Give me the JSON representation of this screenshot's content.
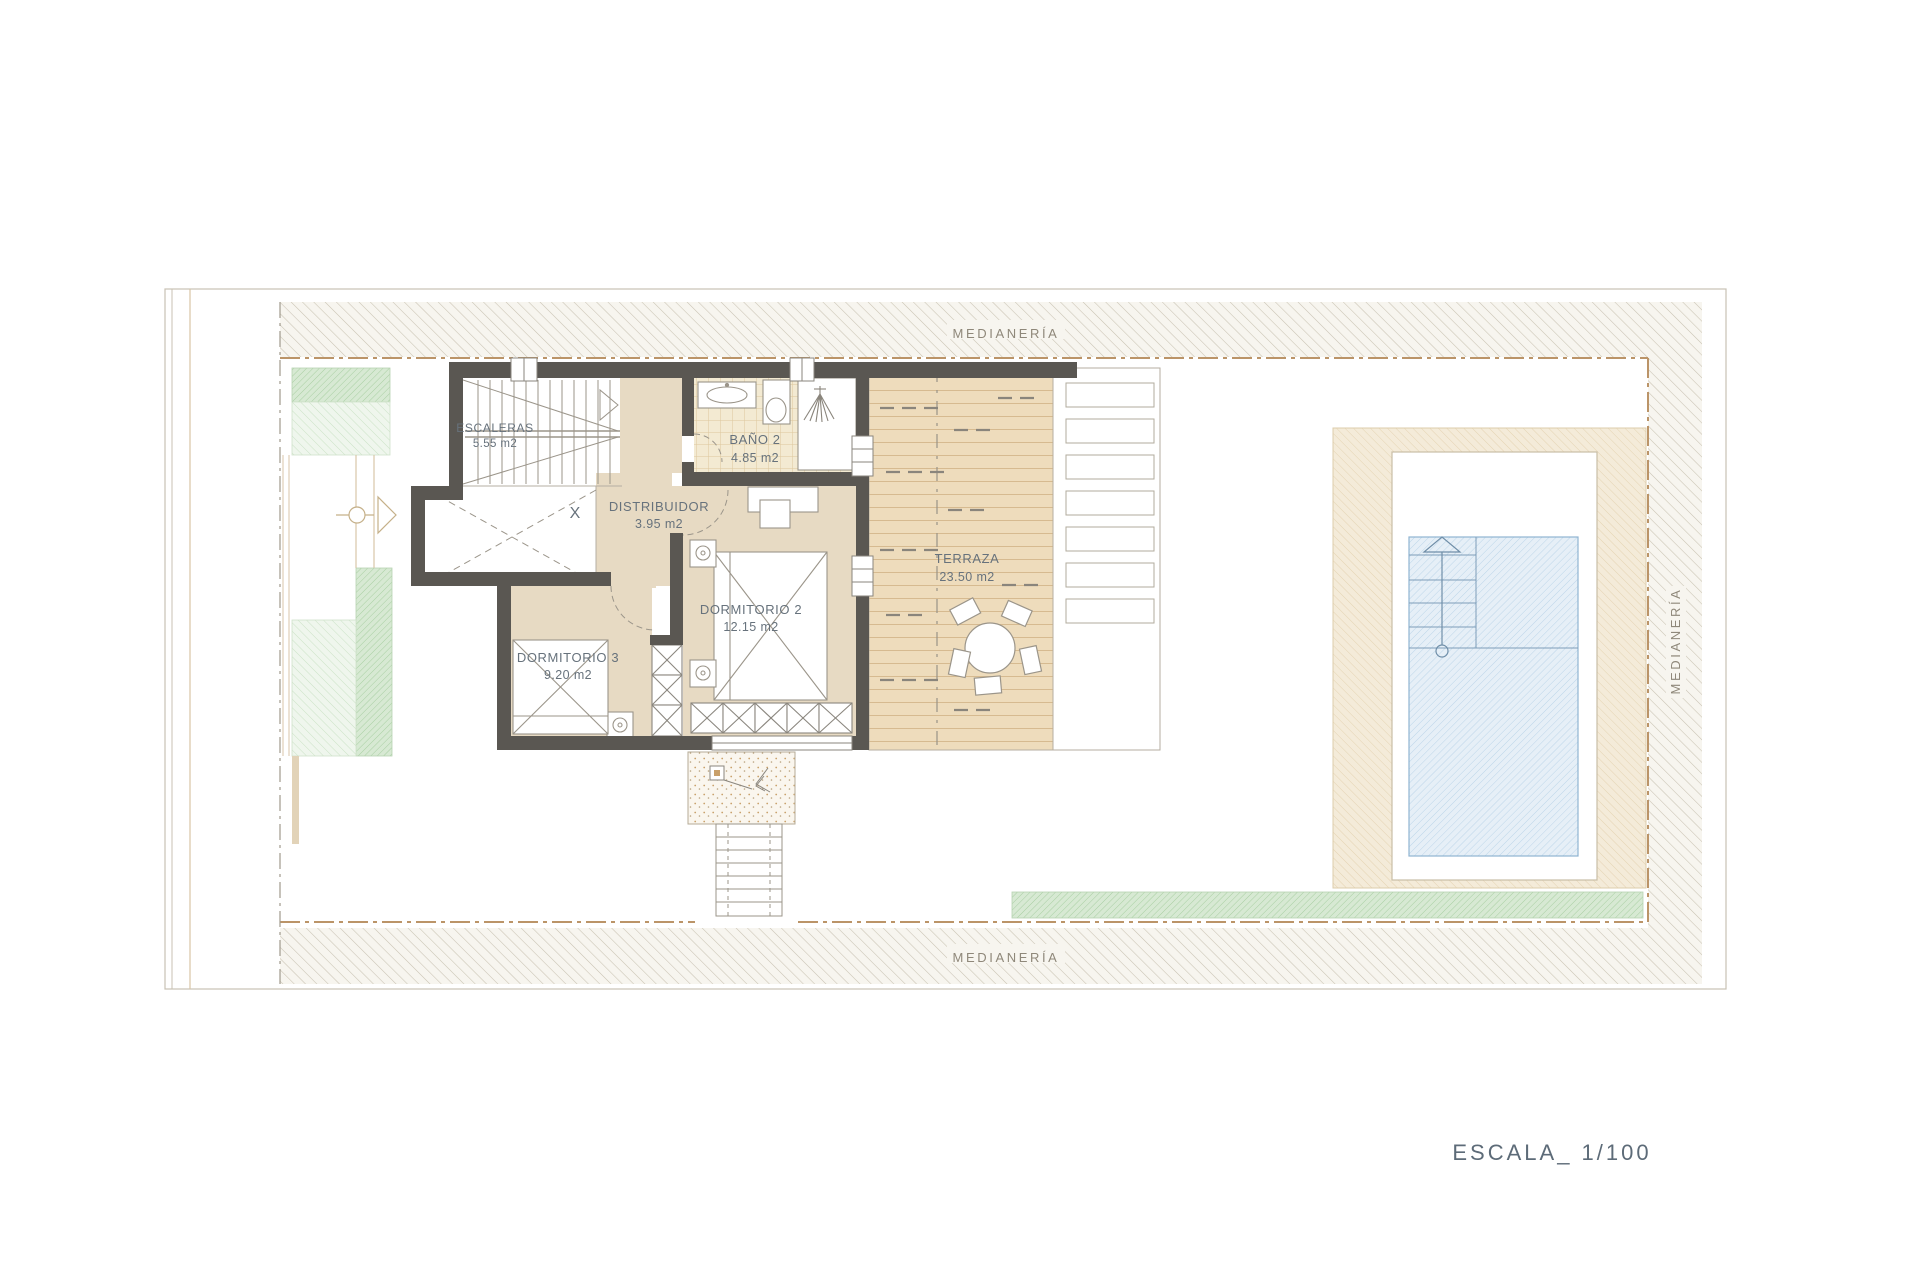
{
  "drawing": {
    "rooms": [
      {
        "name": "ESCALERAS",
        "area": "5.55 m2"
      },
      {
        "name": "BAÑO 2",
        "area": "4.85 m2"
      },
      {
        "name": "DISTRIBUIDOR",
        "area": "3.95 m2"
      },
      {
        "name": "DORMITORIO 2",
        "area": "12.15 m2"
      },
      {
        "name": "DORMITORIO 3",
        "area": "9.20 m2"
      },
      {
        "name": "TERRAZA",
        "area": "23.50 m2"
      }
    ],
    "boundary_labels": {
      "top": "MEDIANERÍA",
      "bottom": "MEDIANERÍA",
      "right": "MEDIANERÍA"
    },
    "void_marker": "X",
    "scale_label": "ESCALA_ 1/100",
    "colors": {
      "wall": "#5a5752",
      "room_floor": "#e7dac3",
      "deck": "#eedcbc",
      "pool_water": "#e6eff7",
      "garden_green": "#a8cfa2",
      "label_text": "#67727c",
      "boundary_text": "#8f887a"
    }
  }
}
